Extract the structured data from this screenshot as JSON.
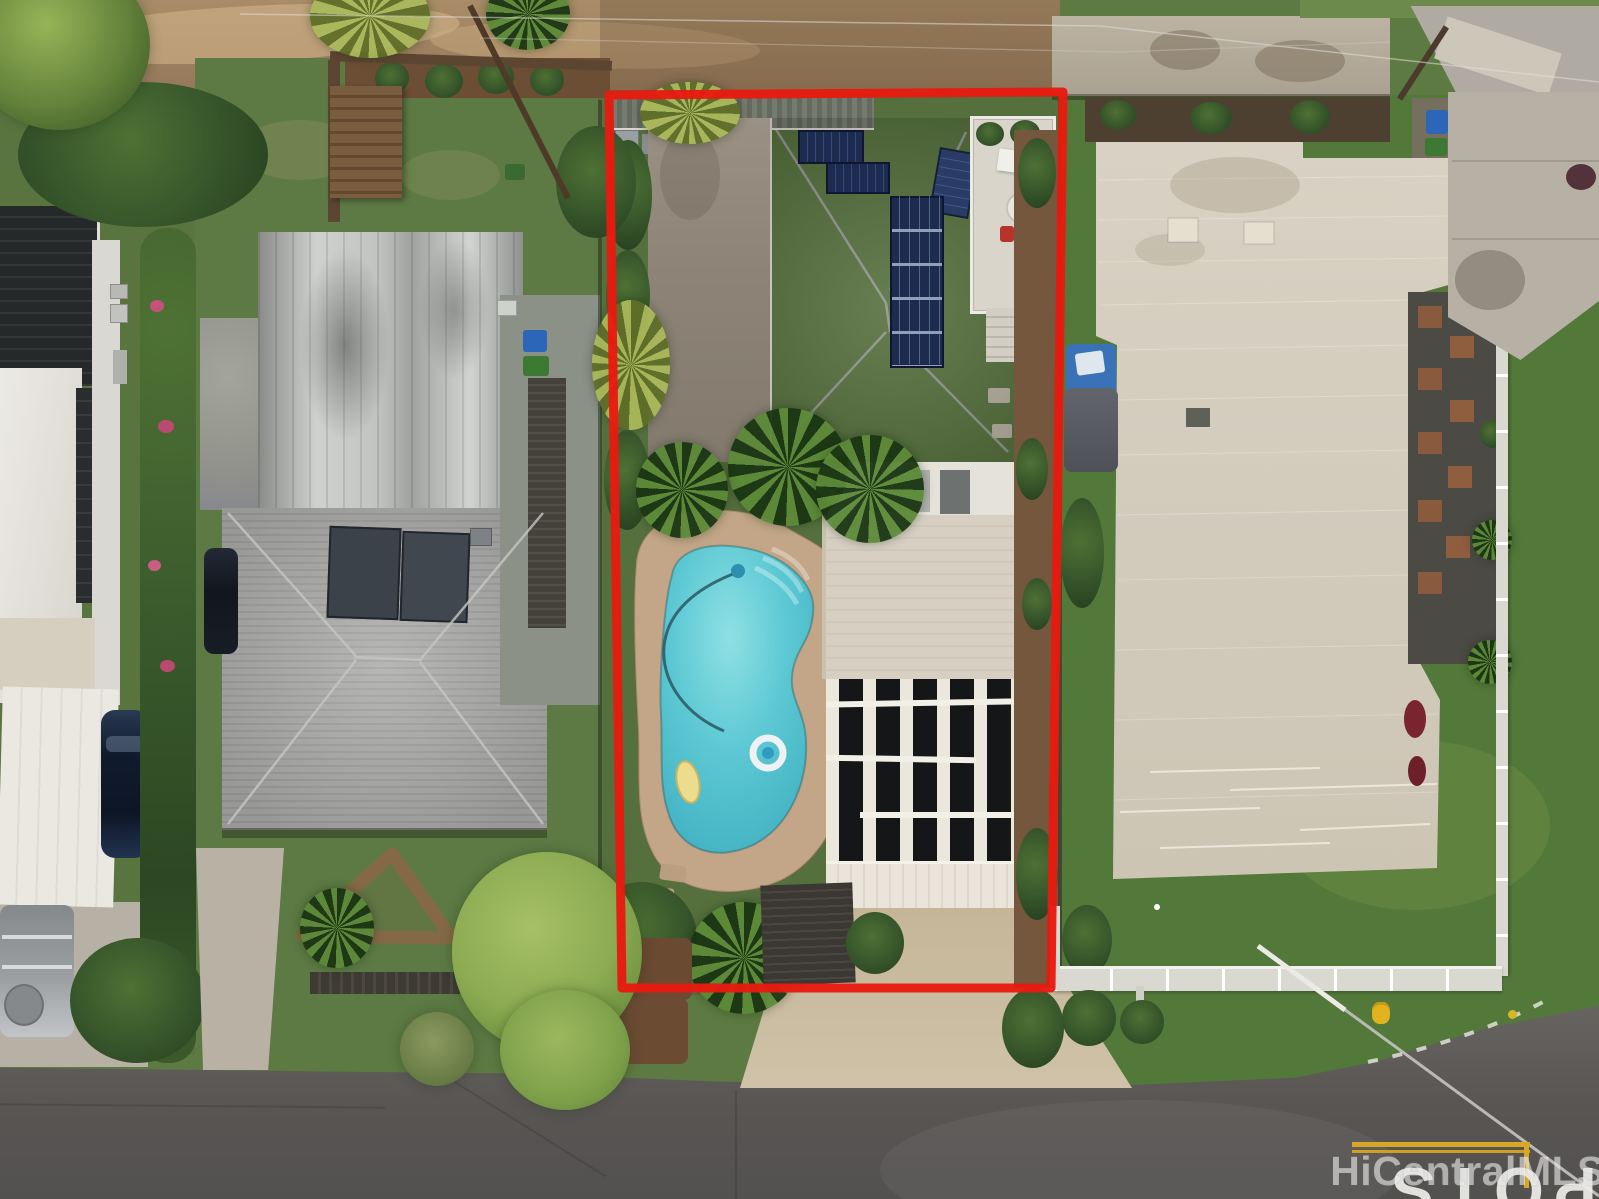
{
  "image": {
    "kind": "aerial-drone-photograph",
    "subject": "residential lot outlined in red with pool, solar roof and detached garage, neighboring homes, street corner"
  },
  "watermark": {
    "text": "HiCentralMLS"
  },
  "road_markings": {
    "stop_text": "STOP",
    "stop_letters": [
      "S",
      "T",
      "O",
      "P"
    ]
  },
  "colors": {
    "outline_red": "#e81a10",
    "pool_water": "#5ec9d4",
    "pool_deck_tan": "#c2a687",
    "shingle_roof_gray": "#7e7f82",
    "flat_roof_taupe": "#8d8477",
    "neighbor_roof_beige": "#d5cec0",
    "metal_roof_silver": "#c7c9c6",
    "garage_solar_black": "#141617",
    "solar_panel_blue": "#1d2b4e",
    "lawn_green": "#567a3c",
    "street_asphalt": "#5b5856",
    "stop_paint_white": "#eeeeea",
    "center_line_yellow": "#d8a825"
  }
}
